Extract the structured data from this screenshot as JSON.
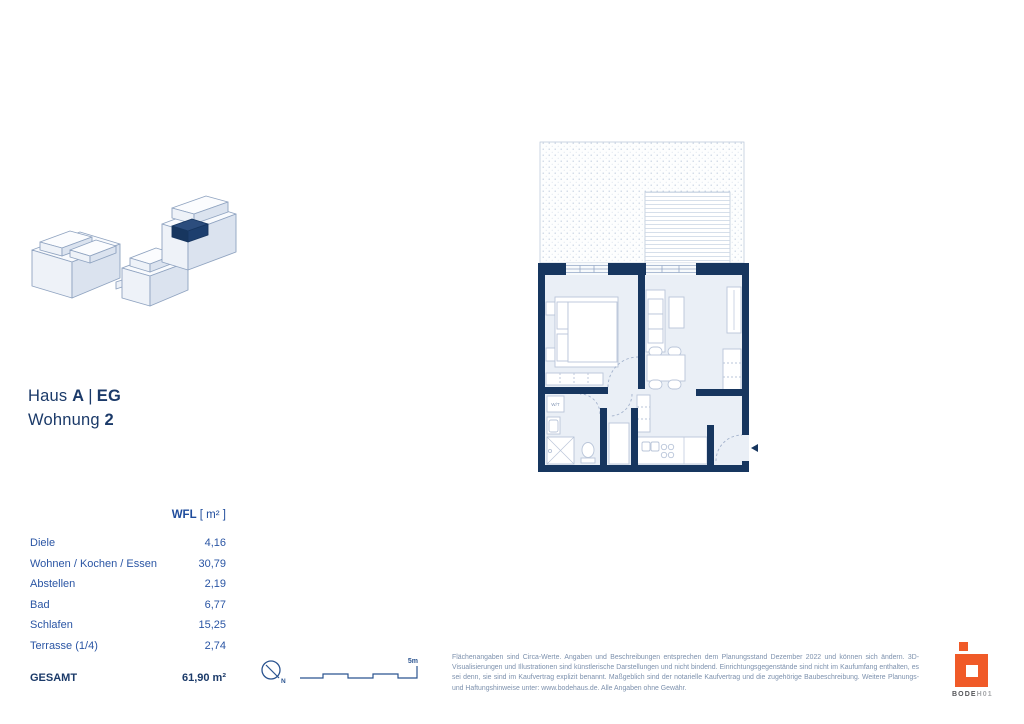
{
  "header": {
    "haus_label": "Haus",
    "haus_value": "A",
    "separator": "|",
    "floor_value": "EG",
    "wohnung_label": "Wohnung",
    "wohnung_value": "2"
  },
  "area_table": {
    "header": {
      "label": "WFL",
      "unit": "[ m² ]"
    },
    "rows": [
      {
        "label": "Diele",
        "value": "4,16"
      },
      {
        "label": "Wohnen / Kochen / Essen",
        "value": "30,79"
      },
      {
        "label": "Abstellen",
        "value": "2,19"
      },
      {
        "label": "Bad",
        "value": "6,77"
      },
      {
        "label": "Schlafen",
        "value": "15,25"
      },
      {
        "label": "Terrasse (1/4)",
        "value": "2,74"
      }
    ],
    "total": {
      "label": "GESAMT",
      "value": "61,90 m²"
    }
  },
  "floor_plan": {
    "wt_label": "W/T"
  },
  "scale": {
    "label": "5m"
  },
  "north": {
    "label": "N"
  },
  "disclaimer": "Flächenangaben sind Circa-Werte. Angaben und Beschreibungen entsprechen dem Planungsstand Dezember 2022 und können sich ändern. 3D-Visualisierungen und Illustrationen sind künstlerische Darstellungen und nicht bindend. Einrichtungsgegenstände sind nicht im Kaufumfang enthalten, es sei denn, sie sind im Kaufvertrag explizit benannt. Maßgeblich sind der notarielle Kaufvertrag und die zugehörige Baubeschreibung. Weitere Planungs- und Haftungshinweise unter: www.bodehaus.de. Alle Angaben ohne Gewähr.",
  "logo": {
    "brand_bold": "BODE",
    "brand_light": "H01"
  },
  "colors": {
    "wall_navy": "#17365f",
    "text_navy": "#1b3a69",
    "table_blue": "#2a55a4",
    "floor_fill": "#eaeff6",
    "furniture_stroke": "#b9c5d9",
    "disclaimer_gray_blue": "#7d91ad",
    "logo_orange": "#f05a28"
  }
}
